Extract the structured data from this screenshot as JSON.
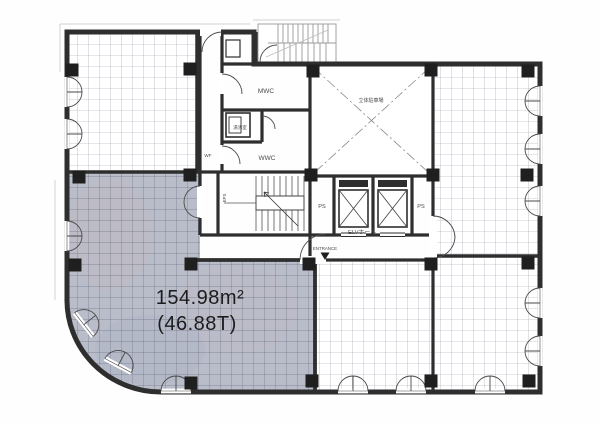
{
  "plan": {
    "unit": {
      "area_m2": "154.98m²",
      "area_tsubo": "(46.88T)"
    },
    "labels": {
      "mwc": "MWC",
      "wwc": "WWC",
      "kitchenette": "湯沸室",
      "parking": "立体駐車場",
      "ps": "PS",
      "elevator_hall": "ELVホール",
      "entrance": "ENTRANCE",
      "corridor": "WF",
      "eps": "EPS"
    },
    "colors": {
      "highlight_fill": "#b9bdc9",
      "highlight_edge": "#74b6be",
      "wall": "#2e2e2e",
      "grid_line": "#969dae"
    }
  }
}
